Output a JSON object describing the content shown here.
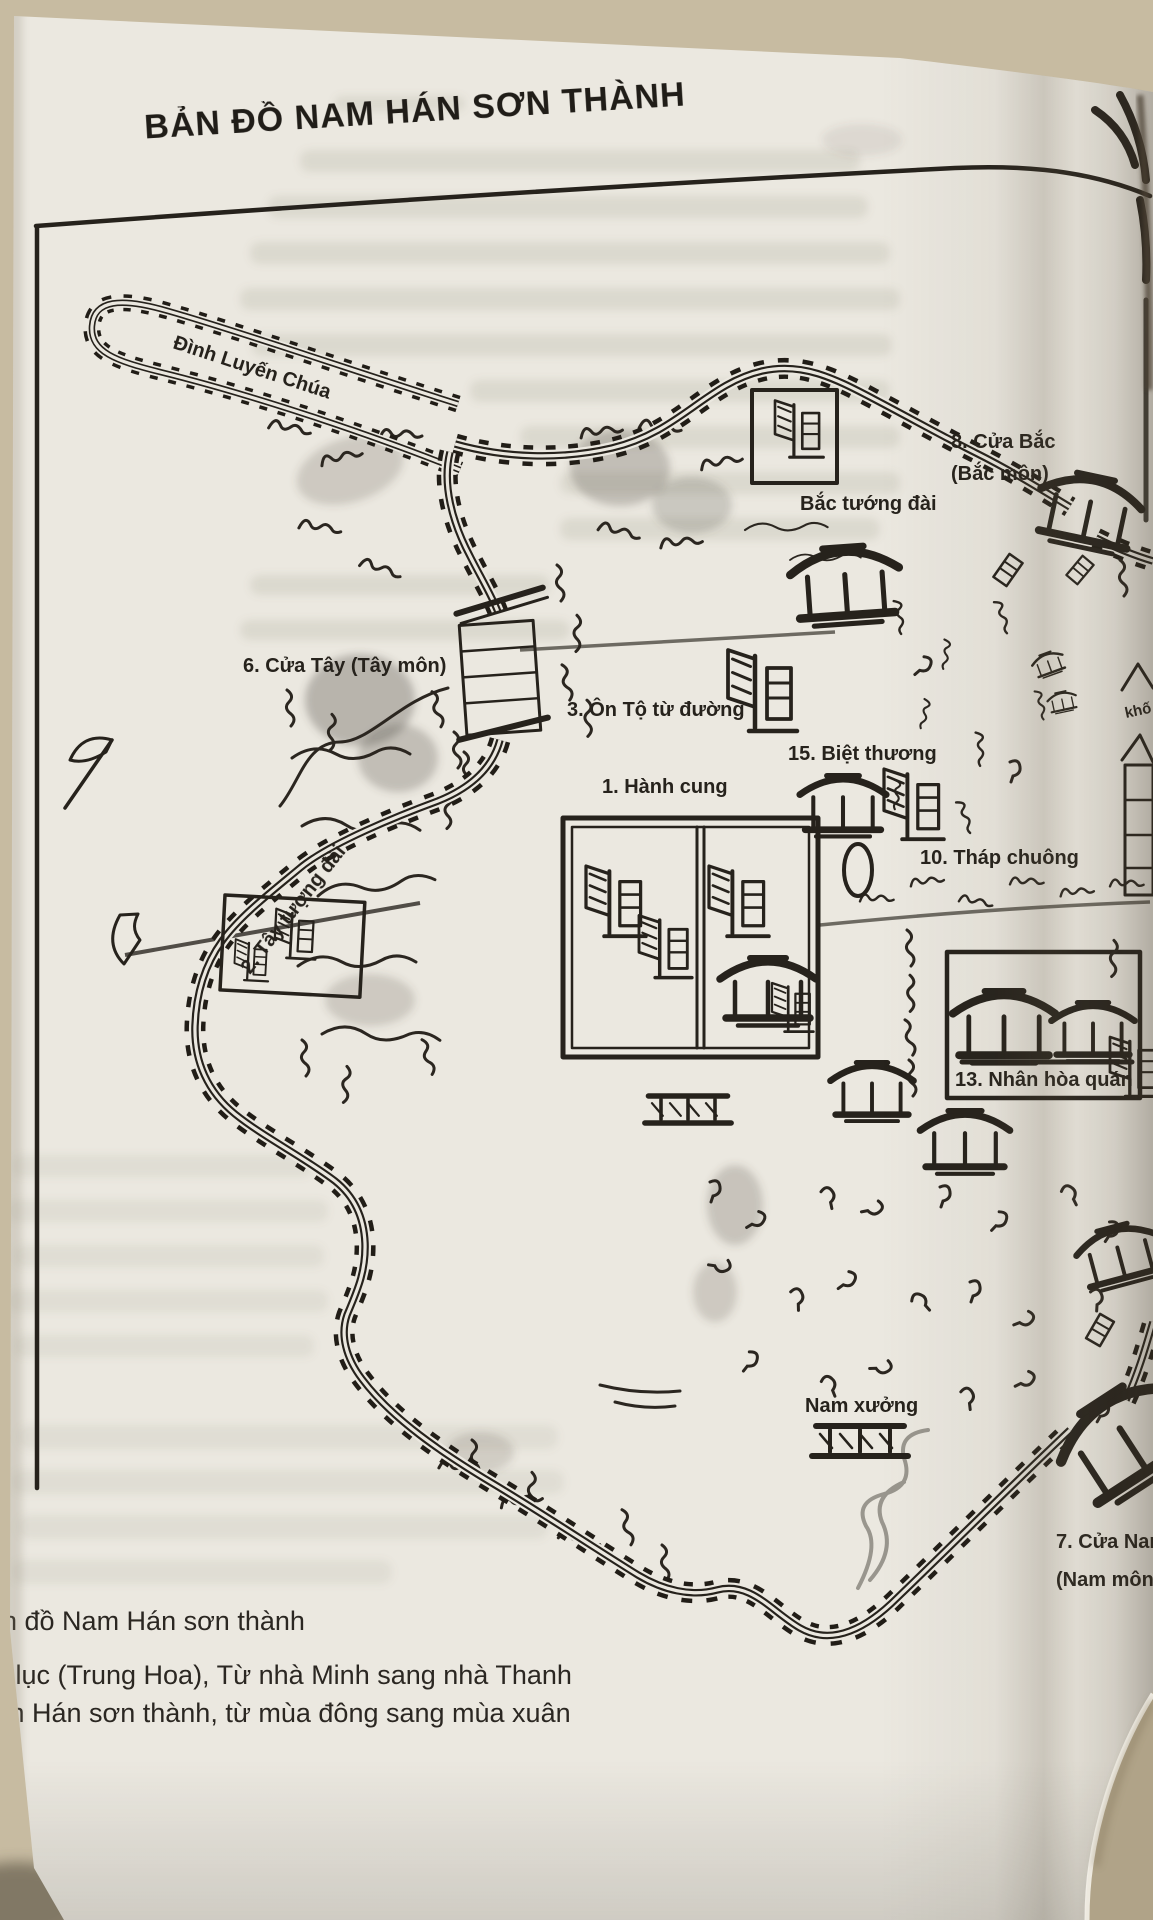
{
  "photo": {
    "title": "BẢN ĐỒ NAM HÁN SƠN THÀNH",
    "map_labels": {
      "spur": "Đình Luyến Chúa",
      "north_gate_line1": "8. Cửa Bắc",
      "north_gate_line2": "(Bắc môn)",
      "north_command_post": "Bắc tướng đài",
      "west_gate": "6. Cửa Tây (Tây môn)",
      "onto_shrine": "3. Ôn Tộ từ đường",
      "storehouse": "15. Biệt thương",
      "palace": "1. Hành cung",
      "bell_tower": "10. Tháp chuông",
      "west_command_post": "2. Tây tượng đài",
      "nhan_hoa_quan": "13. Nhân hòa quán",
      "kho_partial": "khố",
      "south_workshop": "Nam xưởng",
      "south_gate_line1": "7. Cửa Nam",
      "south_gate_line2": "(Nam môn)"
    },
    "caption_lines": [
      "n đồ Nam Hán sơn thành",
      "i lục (Trung Hoa), Từ nhà Minh sang nhà Thanh",
      "m Hán sơn thành, từ mùa đông sang mùa xuân"
    ],
    "colors": {
      "ink": "#26221c",
      "paper": "#ebe8e0",
      "desk": "#c7bba1"
    }
  }
}
